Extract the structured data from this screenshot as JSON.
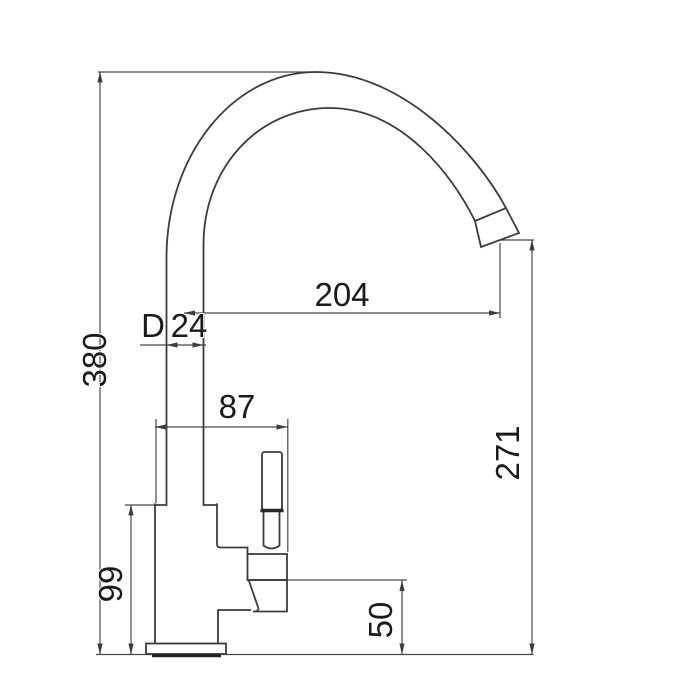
{
  "drawing": {
    "type": "technical-dimension-drawing",
    "view": "side",
    "line_color": "#3c3c3c",
    "background_color": "#ffffff"
  },
  "dimensions": {
    "overall_height": "380",
    "spout_reach": "204",
    "pipe_diameter_prefix": "D",
    "pipe_diameter": "24",
    "body_width": "87",
    "outlet_height": "271",
    "body_height": "99",
    "handle_ref_height": "50"
  }
}
